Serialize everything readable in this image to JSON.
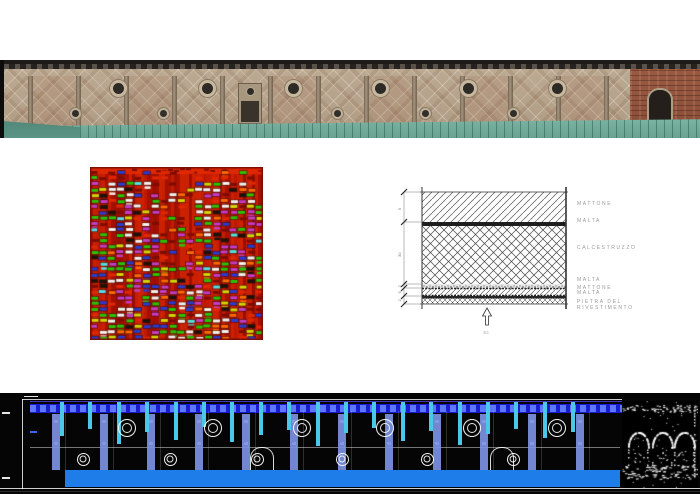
{
  "figure": {
    "background": "#ffffff",
    "width": 700,
    "height": 494
  },
  "photo": {
    "cornice_color": "#1e1b18",
    "wall_color": "#b5a28c",
    "pilaster_color": "#8f7f6a",
    "roof_color": "#7fb7a7",
    "brick_color": "#9a5a42",
    "pilasters": {
      "start": 28,
      "step": 48,
      "count": 13,
      "width": 5
    },
    "upper_oculi": {
      "center_y": 28,
      "diameter": 17,
      "xs": [
        118,
        207,
        293,
        380,
        468,
        557
      ]
    },
    "lower_oculi": {
      "center_y": 53,
      "diameter": 11,
      "xs": [
        75,
        163,
        248,
        337,
        425,
        513
      ]
    },
    "tinted_bays": [
      0,
      2,
      5,
      7,
      9,
      11
    ],
    "niche": {
      "x": 238,
      "y": 23,
      "w": 22,
      "h": 39
    }
  },
  "radargram": {
    "width": 173,
    "height": 173,
    "seed": 7,
    "background": "#b91400",
    "palette": {
      "white": "#f5f2ee",
      "green": "#2cc400",
      "purple": "#c63cc6",
      "blue": "#2b3bd0",
      "yellow": "#d6d600",
      "black": "#1a1208",
      "orange": "#ff6a00",
      "cyan": "#57e0e0",
      "red_bright": "#e02800",
      "red_dark": "#7c0c00"
    }
  },
  "stratigraphy": {
    "labels": [
      "MATTONE",
      "MALTA",
      "CALCESTRUZZO",
      "MALTA",
      "MATTONE",
      "MALTA",
      "PIETRA DEL",
      "RIVESTIMENTO"
    ],
    "label_tops": [
      16,
      33,
      60,
      92,
      100,
      105,
      114,
      120
    ],
    "dims": [
      "5",
      "30",
      "2",
      "5",
      "2"
    ],
    "arrow_label": "E3"
  },
  "cad": {
    "background": "#050505",
    "top_band": {
      "color": "#1b1bd0",
      "dash_color": "#5b78ff",
      "x": 30,
      "w": 592,
      "y": 11,
      "h": 9
    },
    "cyan_bars": {
      "color": "#49c8e8",
      "start": 60,
      "step": 28.4,
      "count": 19,
      "width": 4,
      "top": 9,
      "heights": [
        34,
        27,
        42,
        30,
        38,
        25,
        40,
        33,
        28,
        44,
        31,
        26,
        39,
        29,
        43,
        32,
        27,
        36,
        30
      ]
    },
    "pilasters": {
      "color": "rgba(124,146,226,0.92)",
      "start": 52,
      "step": 47.6,
      "count": 13,
      "width": 8,
      "top": 21,
      "bottom": 77
    },
    "upper_oculi": {
      "center_y": 35,
      "outer": 18,
      "inner": 10,
      "xs": [
        127,
        213,
        302,
        385,
        472,
        557
      ]
    },
    "lower_oculi": {
      "center_y": 66,
      "outer": 13,
      "inner": 7,
      "xs": [
        83,
        170,
        257,
        342,
        427,
        513
      ]
    },
    "arches": {
      "xs": [
        250,
        490
      ],
      "y": 54,
      "w": 22,
      "h": 24
    },
    "bottom_band": {
      "color": "#1e7de8",
      "x": 65,
      "w": 555,
      "y": 77,
      "h": 17
    },
    "speckle": {
      "x": 622,
      "y": 8,
      "w": 76,
      "h": 87,
      "seed": 3
    }
  }
}
